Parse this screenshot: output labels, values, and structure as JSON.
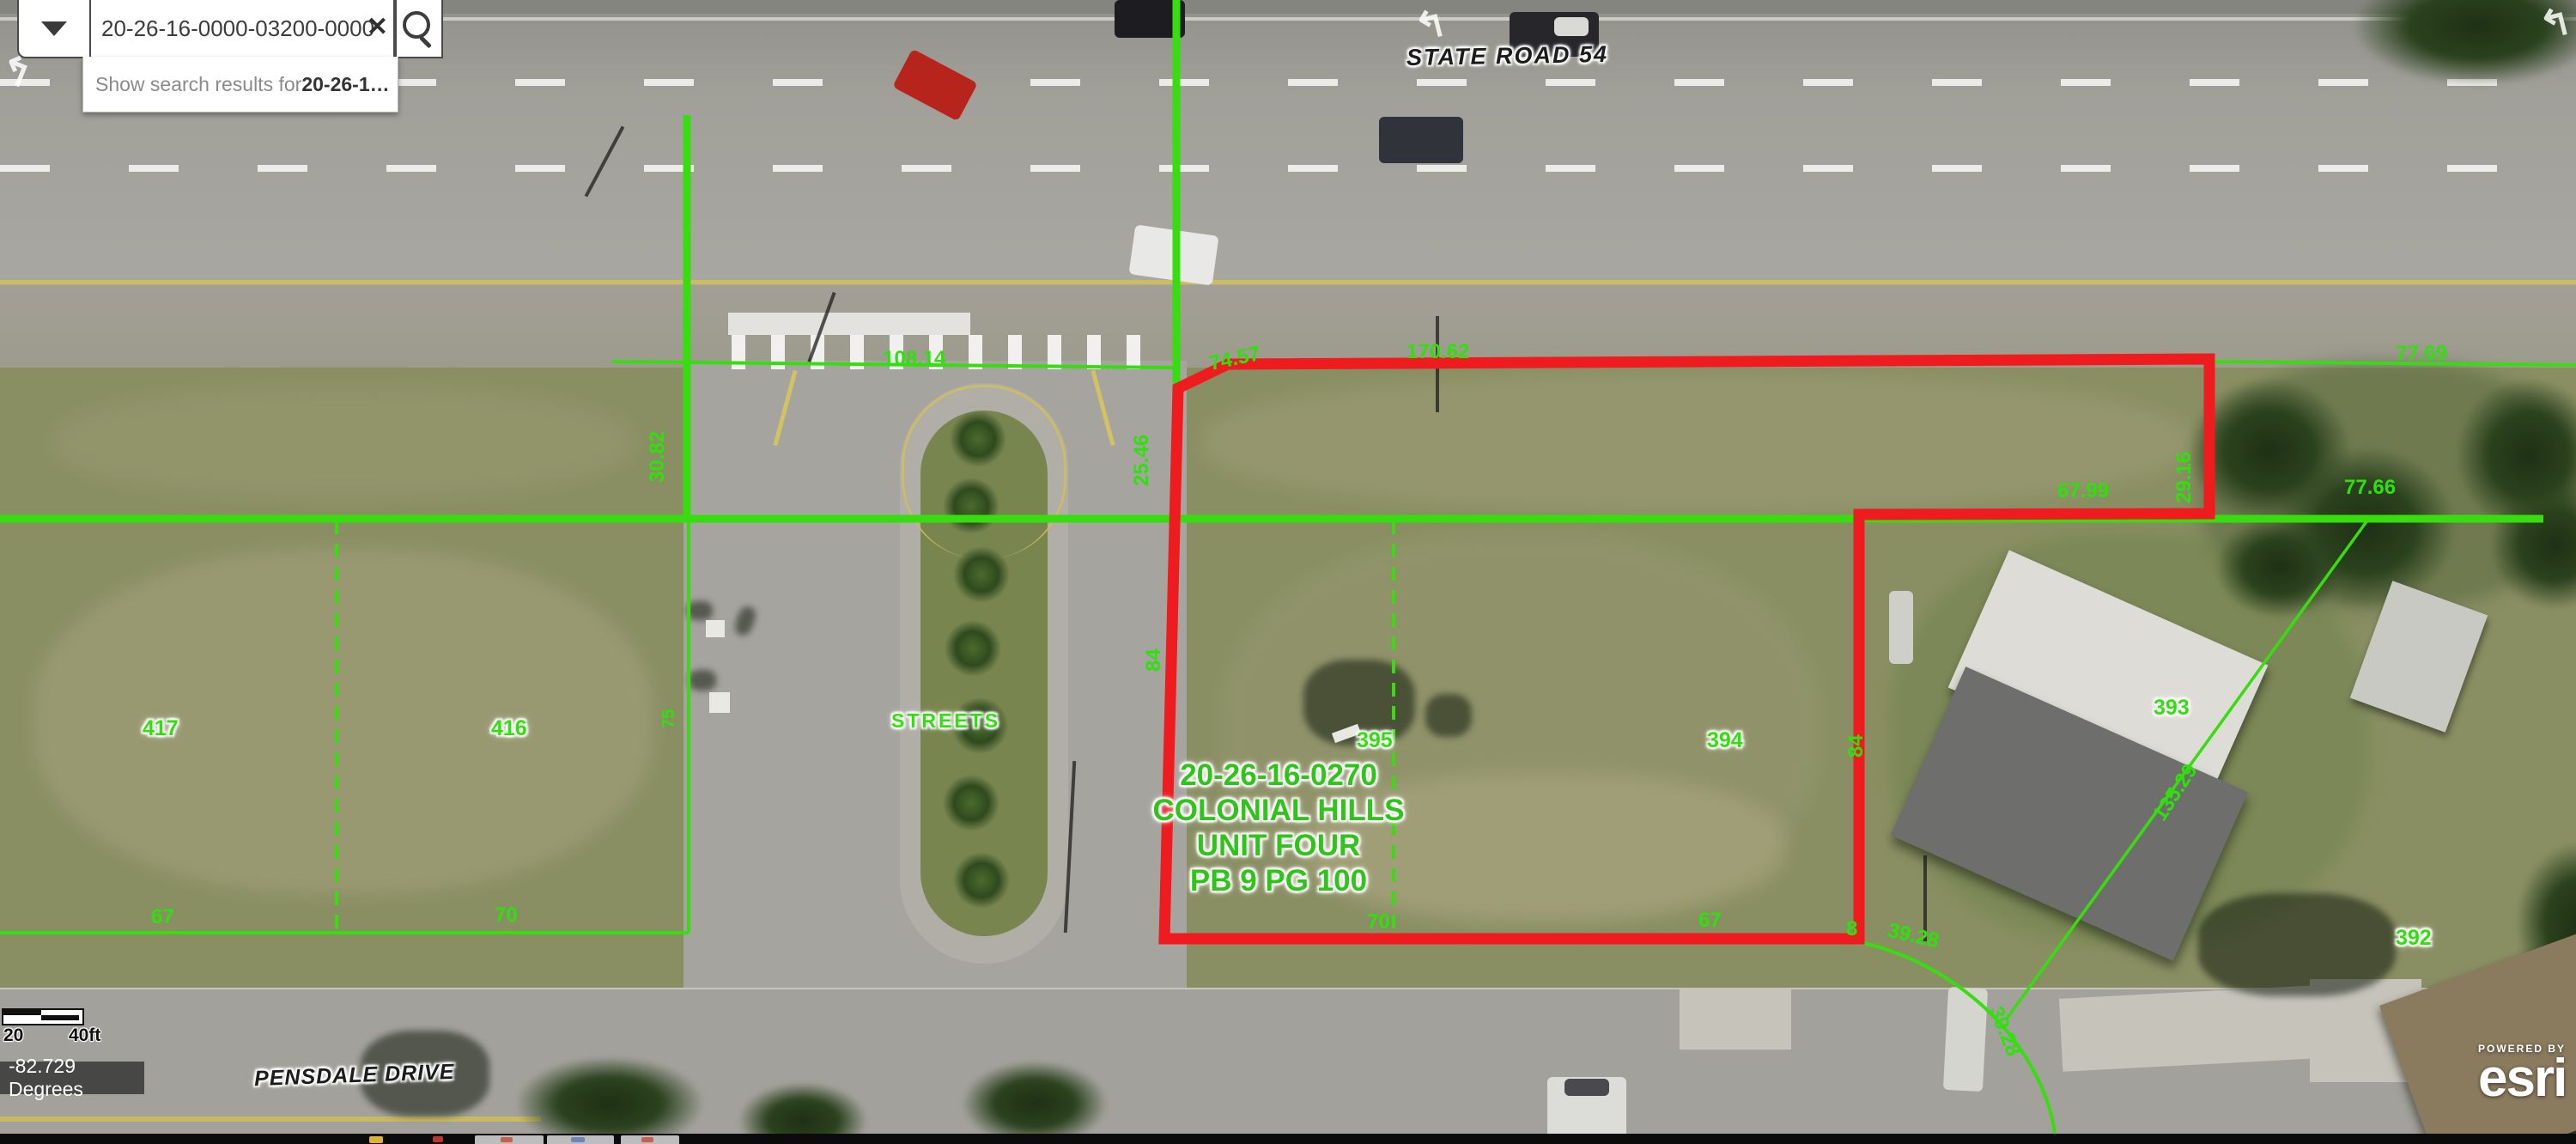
{
  "search": {
    "value": "20-26-16-0000-03200-0000",
    "clear_label": "✕",
    "suggestion_prefix": "Show search results for ",
    "suggestion_term": "20-26-1…"
  },
  "map": {
    "road_labels": {
      "state_road": "STATE ROAD 54",
      "pensdale": "PENSDALE DRIVE",
      "streets": "STREETS"
    },
    "subdivision": {
      "line1": "20-26-16-0270",
      "line2": "COLONIAL HILLS",
      "line3": "UNIT FOUR",
      "line4": "PB 9 PG 100"
    },
    "lots": {
      "n417": "417",
      "n416": "416",
      "n395": "395",
      "n394": "394",
      "n393": "393",
      "n392": "392"
    },
    "dims": {
      "d74_57": "74.57",
      "d170_62": "170.62",
      "d77_69": "77.69",
      "d108_14": "108.14",
      "d30_82": "30.82",
      "d25_46": "25.46",
      "d29_16": "29.16",
      "d67_99": "67.99",
      "d77_66": "77.66",
      "d84_w": "84",
      "d84_e": "84",
      "d75": "75",
      "d67_a": "67",
      "d70_a": "70",
      "d70_b": "70",
      "d67_b": "67",
      "d8": "8",
      "d39_28_a": "39.28",
      "d39_28_b": "39.28",
      "d135_29": "135.29"
    }
  },
  "scalebar": {
    "mid": "20",
    "end": "40ft"
  },
  "status": {
    "coordinates": "-82.729 Degrees"
  },
  "attribution": {
    "powered_by": "POWERED BY",
    "brand": "esri"
  },
  "colors": {
    "parcel_line_green": "#38dd10",
    "highlight_red": "#ee1b1f",
    "label_green": "#2fe10c"
  }
}
